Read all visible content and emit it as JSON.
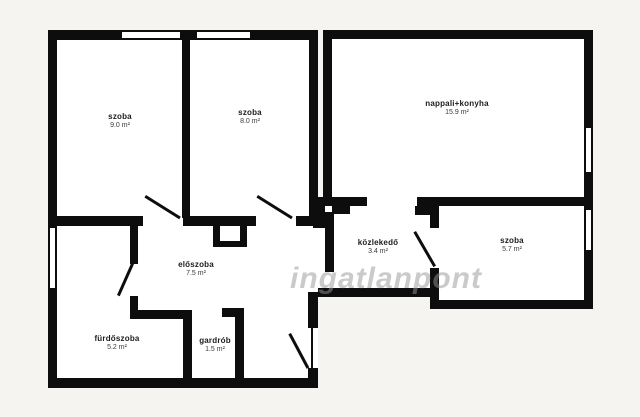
{
  "watermark": {
    "text": "ingatlanpont"
  },
  "colors": {
    "wall": "#0d0d0d",
    "room_fill": "#ffffff",
    "background": "#f5f4f1",
    "watermark_gray": "#969696"
  },
  "rooms": [
    {
      "name": "szoba",
      "area": "9.0 m²"
    },
    {
      "name": "szoba",
      "area": "8.0 m²"
    },
    {
      "name": "nappali+konyha",
      "area": "15.9 m²"
    },
    {
      "name": "közlekedő",
      "area": "3.4 m²"
    },
    {
      "name": "szoba",
      "area": "5.7 m²"
    },
    {
      "name": "előszoba",
      "area": "7.5 m²"
    },
    {
      "name": "fürdőszoba",
      "area": "5.2 m²"
    },
    {
      "name": "gardrób",
      "area": "1.5 m²"
    }
  ]
}
